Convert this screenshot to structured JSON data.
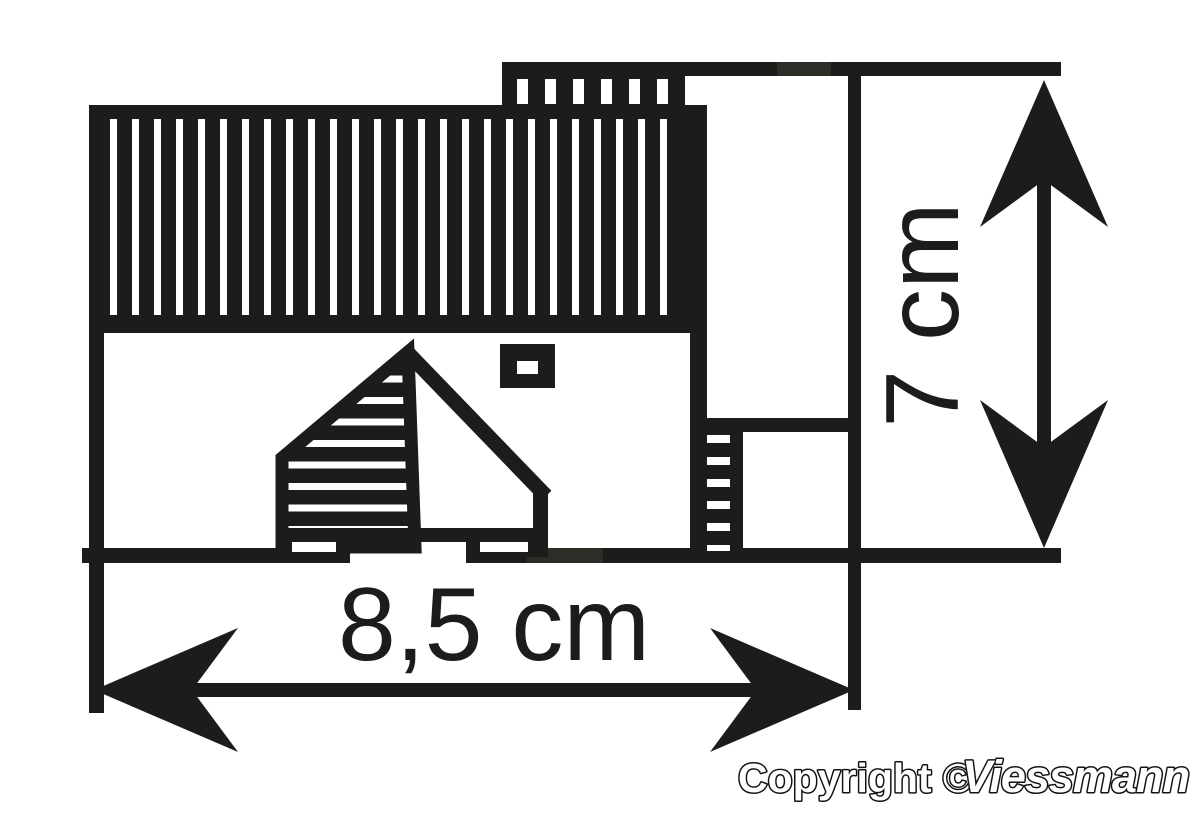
{
  "diagram": {
    "type": "technical-dimension-drawing",
    "subject": "model building footprint with roof, gable house front, rear annex and ladder",
    "width_label": "8,5 cm",
    "height_label": "7 cm"
  },
  "footer": {
    "copyright": "Copyright ©",
    "brand": "Viessmann"
  },
  "colors": {
    "ink": "#1c1c1a",
    "ink_soft": "#2d2d28",
    "background": "#ffffff"
  }
}
